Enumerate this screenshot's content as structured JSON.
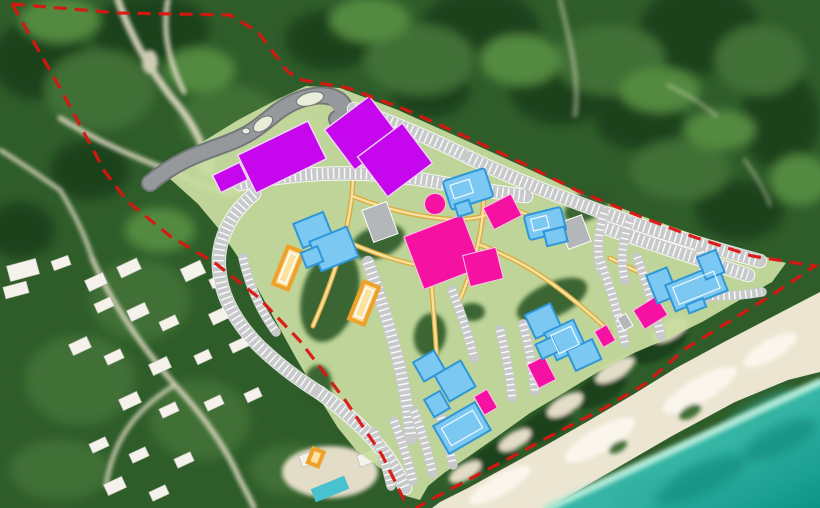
{
  "meta": {
    "description": "Satellite aerial map with a beachfront resort master-plan overlay: red dashed property boundary, light-green development site, gray entrance road and parking rows, yellow pedestrian paths, and color-coded building footprints beside a turquoise sea",
    "canvas": {
      "width": 820,
      "height": 508
    }
  },
  "palette": {
    "forest-base": "#2f5d2a",
    "forest-deep": "#1d421c",
    "forest-mid": "#3f7034",
    "forest-light": "#538a3f",
    "sand-trail": "#e3dcc6",
    "resort-white": "#f4f2ea",
    "pool-aqua": "#49c2cf",
    "beach-sand": "#ece5d1",
    "sand-bright": "#faf6ec",
    "ocean-shallow": "#aee8d6",
    "ocean-mid": "#2fae9d",
    "ocean-deep": "#0c8779",
    "site-green": "#c9dc9f",
    "tree-patch": "#2e5a29",
    "road-gray": "#96999b",
    "road-dark": "#74787a",
    "path-edge": "#dca93c",
    "path-fill": "#f6e2a0",
    "parking-gray": "#c7c9ca",
    "building-gray": "#b4b7b9",
    "building-purple": "#c607ee",
    "building-pink": "#f512a2",
    "building-blue": "#7bc8f2",
    "building-blue-dark": "#2f97d8",
    "court-fill": "#fbe2a0",
    "court-stroke": "#efa22b",
    "boundary-red": "#da1510"
  },
  "features": {
    "boundary": "red-dashed-property-line",
    "site_area": "light-green-master-plan-area",
    "entrance_road": "gray-curved-access-road-with-islands",
    "purple_buildings": 4,
    "pink_buildings": 8,
    "pink_circle_buildings": 1,
    "blue_building_clusters": 6,
    "orange_courts": 3,
    "gray_service_buildings": 3,
    "parking_rows": 21,
    "existing_resort": "white-villas-with-pool-southwest",
    "shoreline": "beach-and-turquoise-sea-southeast"
  }
}
